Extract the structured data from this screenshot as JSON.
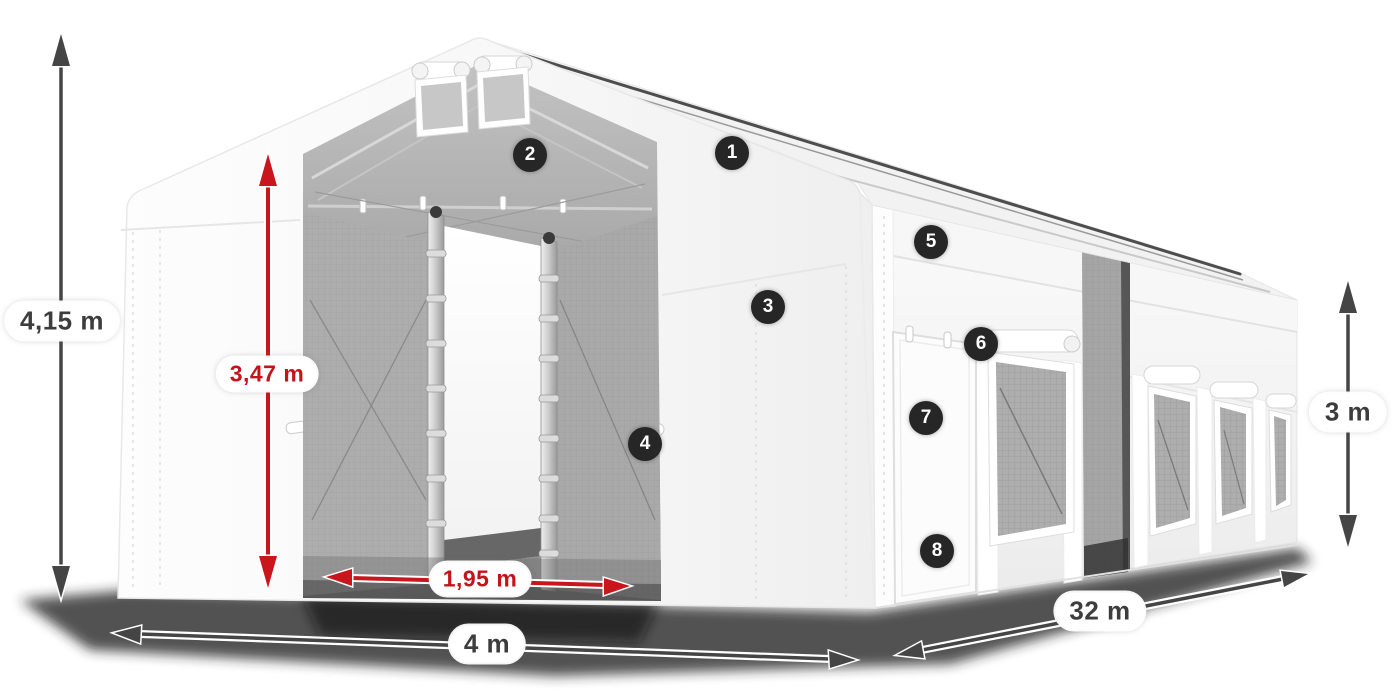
{
  "dimensions": {
    "total_height": "4,15 m",
    "entrance_height": "3,47 m",
    "entrance_width": "1,95 m",
    "front_width": "4 m",
    "length": "32 m",
    "side_height": "3 m"
  },
  "callouts": [
    "1",
    "2",
    "3",
    "4",
    "5",
    "6",
    "7",
    "8"
  ],
  "colors": {
    "dimension_primary": "#454545",
    "dimension_accent": "#c9161c",
    "label_text_primary": "#3d3d3d",
    "label_text_accent": "#c3131b",
    "label_background": "#ffffff",
    "badge_background": "#262626",
    "badge_number": "#ffffff",
    "tent_fabric": "#ffffff",
    "interior_mesh": "#a6a6a6"
  }
}
